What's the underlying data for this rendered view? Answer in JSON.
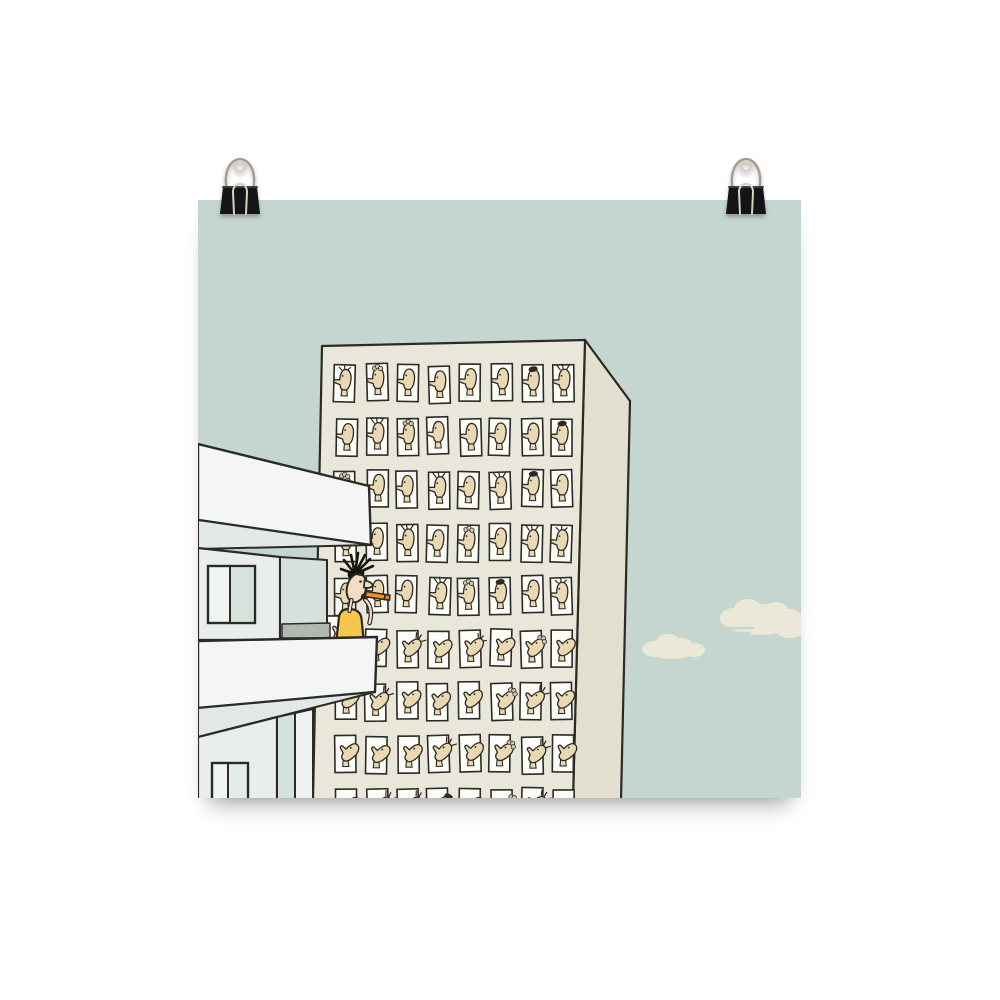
{
  "scene": {
    "background_color": "#ffffff",
    "poster": {
      "x": 198,
      "y": 200,
      "width": 603,
      "height": 598,
      "sky_color": "#c5d6d0"
    },
    "binder_clips": {
      "body_color": "#141417",
      "body_sheen": "#3e3e45",
      "wire_color": "#a79c8a",
      "wire_highlight": "#d8d1c2",
      "positions": [
        {
          "left": 212
        },
        {
          "left": 718
        }
      ]
    },
    "clouds": {
      "color": "#ebe8d8",
      "small_lumps": [
        [
          457,
          449,
          13,
          8
        ],
        [
          470,
          443,
          12,
          9
        ],
        [
          483,
          446,
          12,
          8
        ],
        [
          496,
          450,
          11,
          7
        ],
        [
          474,
          452,
          20,
          7
        ]
      ],
      "large_lumps": [
        [
          536,
          418,
          14,
          10
        ],
        [
          550,
          410,
          14,
          11
        ],
        [
          564,
          414,
          13,
          10
        ],
        [
          578,
          412,
          13,
          10
        ],
        [
          592,
          418,
          12,
          9
        ],
        [
          602,
          425,
          12,
          9
        ],
        [
          562,
          425,
          30,
          10
        ],
        [
          592,
          430,
          14,
          8
        ]
      ],
      "large_streaks": [
        [
          527,
          428,
          28
        ],
        [
          530,
          433,
          22
        ]
      ]
    },
    "high_rise": {
      "outline_color": "#2b2a25",
      "front_color": "#e9e7da",
      "side_color": "#e2dfd0",
      "front_polygon": [
        [
          124,
          146
        ],
        [
          387,
          140
        ],
        [
          375,
          600
        ],
        [
          115,
          600
        ]
      ],
      "side_polygon": [
        [
          387,
          140
        ],
        [
          432,
          201
        ],
        [
          423,
          600
        ],
        [
          375,
          600
        ]
      ],
      "window_grid": {
        "cols": 8,
        "rows": 9,
        "x0": 137,
        "y0": 165,
        "dx": 31,
        "dy": 53,
        "w": 21,
        "h": 37
      },
      "window_fill": "#fdfdf8",
      "face_skin": "#ead8b2",
      "hair_gray": "#cbc5b8",
      "faces": [
        [
          "Lf",
          "Lc",
          "L",
          "L",
          "L",
          "L",
          "Lm",
          "Ls"
        ],
        [
          "L",
          "Ls",
          "Lc",
          "L",
          "L",
          "L",
          "L",
          "Lm"
        ],
        [
          "Lc",
          "L",
          "L",
          "Ls",
          "L",
          "Ls",
          "Lm",
          "L"
        ],
        [
          "L",
          "L",
          "Ls",
          "L",
          "Lc",
          "L",
          "Ls",
          "Lf"
        ],
        [
          "L",
          "L",
          "L",
          "Ls",
          "Lc",
          "Lm",
          "L",
          "Lf"
        ],
        [
          "U",
          "U",
          "Us",
          "U",
          "Uf",
          "U",
          "Uc",
          "U"
        ],
        [
          "U",
          "Us",
          "U",
          "U",
          "U",
          "Uc",
          "Us",
          "U"
        ],
        [
          "U",
          "U",
          "U",
          "Us",
          "U",
          "Uc",
          "Us",
          "U"
        ],
        [
          "U",
          "Us",
          "Us",
          "Um",
          "U",
          "Uc",
          "Us",
          "U"
        ]
      ]
    },
    "apartment": {
      "outline_color": "#2b2a25",
      "slab_color": "#f3f6f4",
      "soffit_color": "#e2e8e5",
      "wall_color": "#e9eeec",
      "panel_green": "#d5e2dc",
      "panel_light": "#edf1ef",
      "floor_gray": "#b3b7b4",
      "pane_light": "#f0f5f2",
      "pane_green": "#d6e3dd",
      "pane_soft": "#e4ece8",
      "top_slab": [
        [
          0,
          244
        ],
        [
          171,
          286
        ],
        [
          173,
          345
        ],
        [
          0,
          320
        ]
      ],
      "top_soffit": [
        [
          0,
          320
        ],
        [
          173,
          345
        ],
        [
          0,
          349
        ]
      ],
      "upper_wall": [
        [
          0,
          348
        ],
        [
          82,
          357
        ],
        [
          82,
          440
        ],
        [
          0,
          440
        ]
      ],
      "upper_window": {
        "x": 10,
        "y": 366,
        "w": 47,
        "h": 57,
        "split": 32
      },
      "mid_panel": [
        [
          82,
          357
        ],
        [
          129,
          360
        ],
        [
          129,
          438
        ],
        [
          82,
          438
        ]
      ],
      "floor_strip": [
        [
          84,
          424
        ],
        [
          132,
          423
        ],
        [
          132,
          438
        ],
        [
          84,
          438
        ]
      ],
      "bottom_slab": [
        [
          0,
          441
        ],
        [
          179,
          437
        ],
        [
          177,
          492
        ],
        [
          0,
          508
        ]
      ],
      "bottom_soffit": [
        [
          0,
          508
        ],
        [
          177,
          492
        ],
        [
          0,
          537
        ]
      ],
      "lower_wall": [
        [
          0,
          537
        ],
        [
          79,
          517
        ],
        [
          79,
          600
        ],
        [
          0,
          600
        ]
      ],
      "lower_green": [
        [
          79,
          517
        ],
        [
          97,
          513
        ],
        [
          97,
          600
        ],
        [
          79,
          600
        ]
      ],
      "lower_light": [
        [
          97,
          513
        ],
        [
          115,
          509
        ],
        [
          115,
          600
        ],
        [
          97,
          600
        ]
      ],
      "lower_window": {
        "x": 14,
        "y": 563,
        "w": 36,
        "h": 37,
        "split": 30
      }
    },
    "character": {
      "skin": "#f4ddc6",
      "hair": "#17160f",
      "shirt": "#f5c84d",
      "outline": "#2b2a25",
      "cigar_body": "#ef9224",
      "cigar_tip": "#f57a0e"
    }
  }
}
